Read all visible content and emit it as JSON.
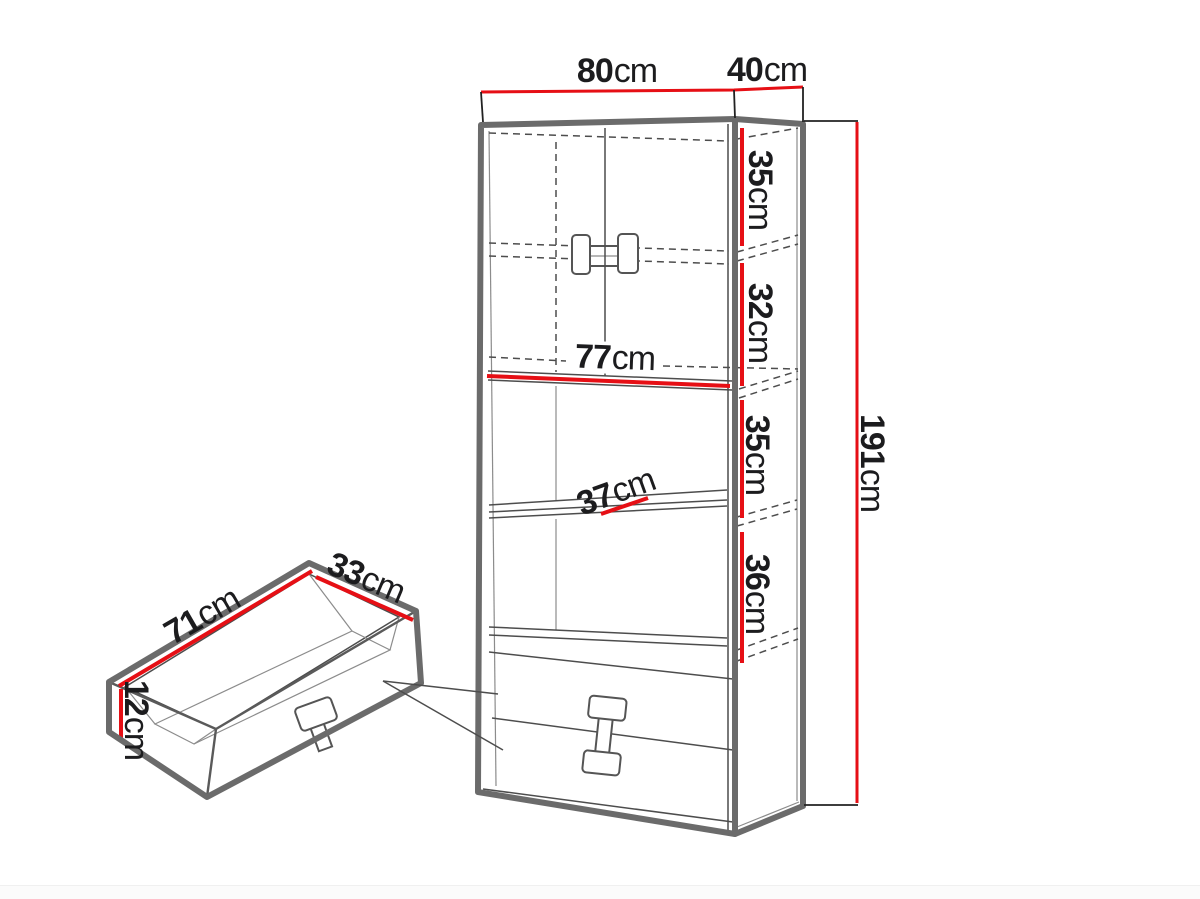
{
  "diagram": {
    "title": "Bookcase with drawers - dimension diagram",
    "colors": {
      "dimension_red": "#e60f15",
      "outline_gray": "#6b6b6b",
      "text": "#1c1c1e"
    }
  },
  "labels": {
    "top_width": {
      "value": "80",
      "unit": "cm"
    },
    "top_depth": {
      "value": "40",
      "unit": "cm"
    },
    "total_height": {
      "value": "191",
      "unit": "cm"
    },
    "section_1": {
      "value": "35",
      "unit": "cm"
    },
    "section_2": {
      "value": "32",
      "unit": "cm"
    },
    "section_3": {
      "value": "35",
      "unit": "cm"
    },
    "section_4": {
      "value": "36",
      "unit": "cm"
    },
    "shelf_width": {
      "value": "77",
      "unit": "cm"
    },
    "shelf_depth": {
      "value": "37",
      "unit": "cm"
    },
    "drawer_length": {
      "value": "71",
      "unit": "cm"
    },
    "drawer_depth": {
      "value": "33",
      "unit": "cm"
    },
    "drawer_height": {
      "value": "12",
      "unit": "cm"
    }
  }
}
